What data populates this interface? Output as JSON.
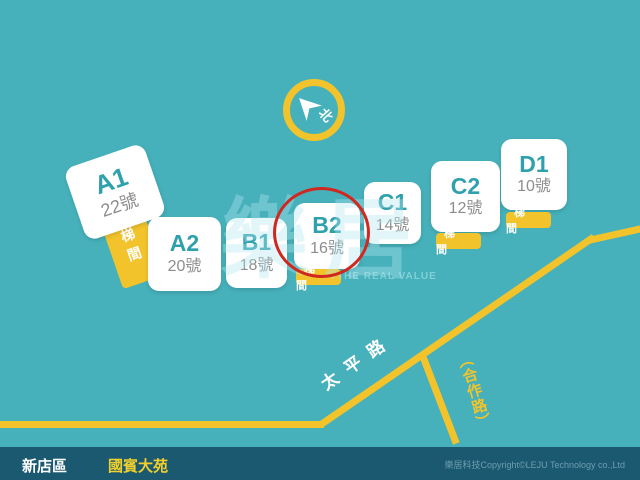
{
  "theme": {
    "background": "#46b1bb",
    "accent_yellow": "#f2c32a",
    "bar_background": "#1b5971",
    "highlight_red": "#d02820",
    "building_label_teal": "#2fa0ad",
    "community_yellow": "#f2d02c"
  },
  "compass": {
    "label": "北"
  },
  "roads": {
    "taiping": "太平路",
    "hezuo": "（合作路）"
  },
  "stair_label": "梯間",
  "watermark": {
    "logo": "樂居",
    "tagline": "THE REAL VALUE"
  },
  "buildings": [
    {
      "label": "A1",
      "number": "22號",
      "highlighted": false
    },
    {
      "label": "A2",
      "number": "20號",
      "highlighted": false
    },
    {
      "label": "B1",
      "number": "18號",
      "highlighted": false
    },
    {
      "label": "B2",
      "number": "16號",
      "highlighted": true
    },
    {
      "label": "C1",
      "number": "14號",
      "highlighted": false
    },
    {
      "label": "C2",
      "number": "12號",
      "highlighted": false
    },
    {
      "label": "D1",
      "number": "10號",
      "highlighted": false
    }
  ],
  "footer": {
    "district": "新店區",
    "community": "國賓大苑",
    "copyright": "樂居科技Copyright©LEJU Technology co.,Ltd"
  }
}
